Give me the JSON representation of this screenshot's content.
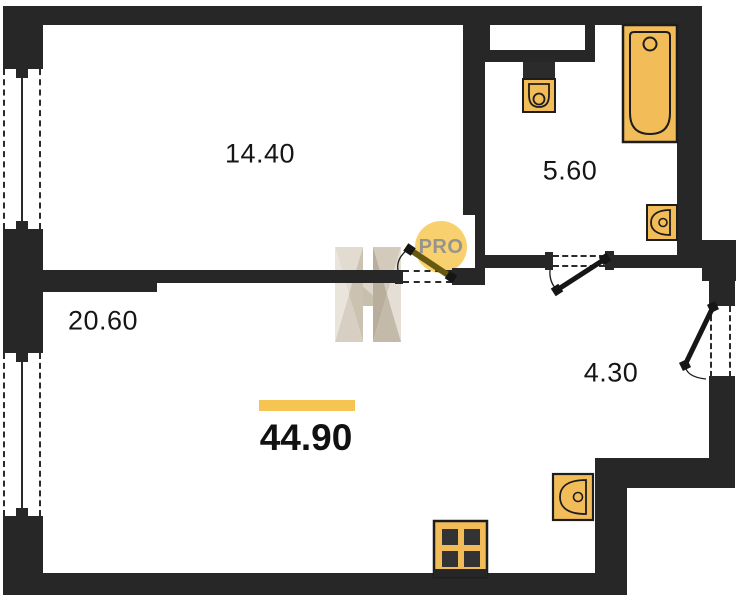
{
  "plan": {
    "watermark": {
      "badge_text": "PRO"
    },
    "total": {
      "area": "44.90"
    },
    "rooms": [
      {
        "id": "living-room",
        "area": "14.40"
      },
      {
        "id": "bathroom",
        "area": "5.60"
      },
      {
        "id": "kitchen-living-room",
        "area": "20.60"
      },
      {
        "id": "hallway",
        "area": "4.30"
      }
    ],
    "colors": {
      "wall": "#272727",
      "fixture_fill": "#f2bd58",
      "fixture_stroke": "#1d1d1d",
      "accent_bar": "#f5c453",
      "badge_fill": "#f8d06d",
      "badge_text_color": "#96948e",
      "door_leaf": "#675811",
      "watermark_beige": "#d7cfc1"
    },
    "fixtures": [
      "bathtub",
      "toilet",
      "bathroom-sink",
      "kitchen-sink",
      "stove"
    ],
    "doors": [
      "room-door",
      "bathroom-door",
      "entrance-door"
    ],
    "windows": [
      "left-window-top",
      "left-window-bottom"
    ]
  }
}
